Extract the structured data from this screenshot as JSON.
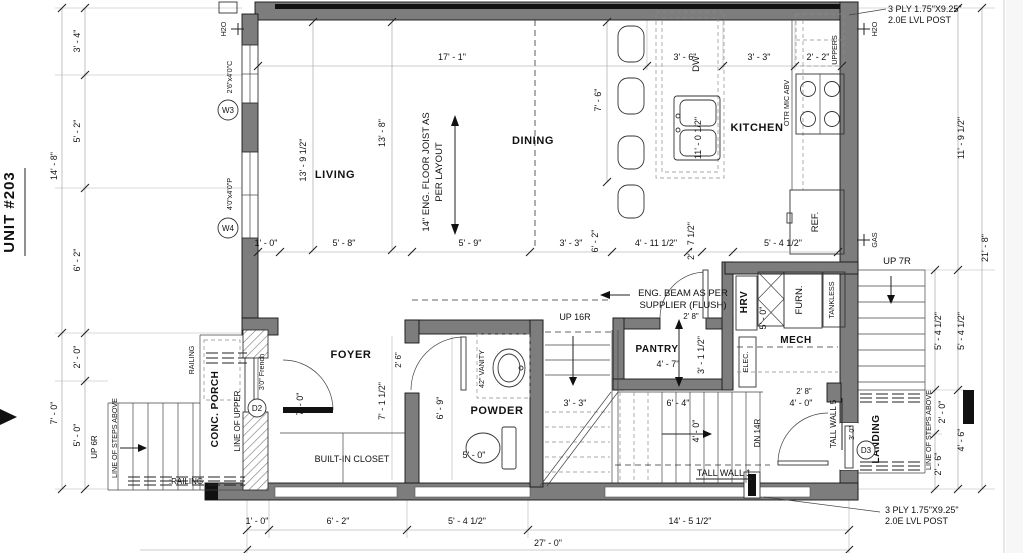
{
  "title": "UNIT #203",
  "rooms": {
    "living": "LIVING",
    "dining": "DINING",
    "kitchen": "KITCHEN",
    "foyer": "FOYER",
    "powder": "POWDER",
    "pantry": "PANTRY",
    "mech": "MECH",
    "landing": "LANDING",
    "conc_porch": "CONC. PORCH",
    "closet": "BUILT-IN CLOSET"
  },
  "notes": {
    "joist1": "14\" ENG. FLOOR JOIST AS",
    "joist2": "PER LAYOUT",
    "beam1": "ENG. BEAM AS PER",
    "beam2": "SUPPLIER (FLUSH)",
    "lvl1": "3 PLY 1.75\"X9.25\"",
    "lvl2": "2.0E LVL POST",
    "otr": "OTR MIC ABV",
    "uppers": "UPPERS",
    "dw": "DW",
    "ref": "REF.",
    "hrv": "HRV",
    "furn": "FURN.",
    "tankless": "TANKLESS",
    "elec": "ELEC.",
    "vanity": "42\" VANITY",
    "tall_wall_1": "TALL WALL 1",
    "tall_wall_5": "TALL WALL 5",
    "railing_top": "RAILING",
    "railing_bottom": ":RAILING",
    "line_of_steps": "LINE OF STEPS ABOVE",
    "line_of_upper": "LINE OF UPPER",
    "h2o": "H2O",
    "gas": "GAS",
    "up16r": "UP 16R",
    "dn14r": "DN 14R",
    "up7r": "UP 7R",
    "up6r": "UP 6R"
  },
  "symbols": {
    "w3": "W3",
    "w3_size": "2'6\"x4'0\"C",
    "w4": "W4",
    "w4_size": "4'0\"x4'0\"P",
    "d2": "D2",
    "d2_size": "3'0\" French",
    "d3": "D3",
    "d3_size": "3' 0\""
  },
  "dims": {
    "left_total_top": "14' - 8\"",
    "left_total_bottom": "7' - 0\"",
    "left_1": "3' - 4\"",
    "left_2": "5' - 2\"",
    "left_3": "6' - 2\"",
    "left_4": "2' - 0\"",
    "left_5": "5' - 0\"",
    "top_1": "17' - 1\"",
    "top_2": "3' - 6\"",
    "top_3": "3' - 3\"",
    "top_4": "2' - 2\"",
    "living_depth": "13' - 9 1/2\"",
    "living_depth2": "13' - 8\"",
    "dining_depth": "7' - 6\"",
    "island": "11' - 0 1/2\"",
    "mid_1": "1' - 0\"",
    "mid_2": "5' - 8\"",
    "mid_3": "5' - 9\"",
    "mid_4": "3' - 3\"",
    "mid_5": "6' - 2\"",
    "mid_6": "4' - 11 1/2\"",
    "mid_7": "2' - 7 1/2\"",
    "mid_8": "5' - 4 1/2\"",
    "right_1": "11' - 9 1/2\"",
    "right_2": "21' - 8\"",
    "right_3": "5' - 4 1/2\"",
    "right_4": "5' - 4 1/2\"",
    "right_5": "2' - 0\"",
    "right_6": "2' - 6\"",
    "right_7": "4' - 6\"",
    "pantry_w": "4' - 7\"",
    "pantry_h": "3' - 1 1/2\"",
    "pantry_door": "2' 8\"",
    "mech_dim": "5' - 0\"",
    "mech_door_w": "2' 8\"",
    "mech_door_clear": "4' - 0\"",
    "stair_1": "3' - 3\"",
    "stair_2": "6' - 4\"",
    "stair_3": "4' - 0\"",
    "foyer_w": "7' - 0\"",
    "foyer_d": "7' - 1 1/2\"",
    "powder_door": "2' 6\"",
    "powder_d": "6' - 9\"",
    "powder_w": "5' - 0\"",
    "bottom_1": "1' - 0\"",
    "bottom_2": "6' - 2\"",
    "bottom_3": "5' - 4 1/2\"",
    "bottom_4": "14' - 5 1/2\"",
    "bottom_total": "27' - 0\""
  }
}
